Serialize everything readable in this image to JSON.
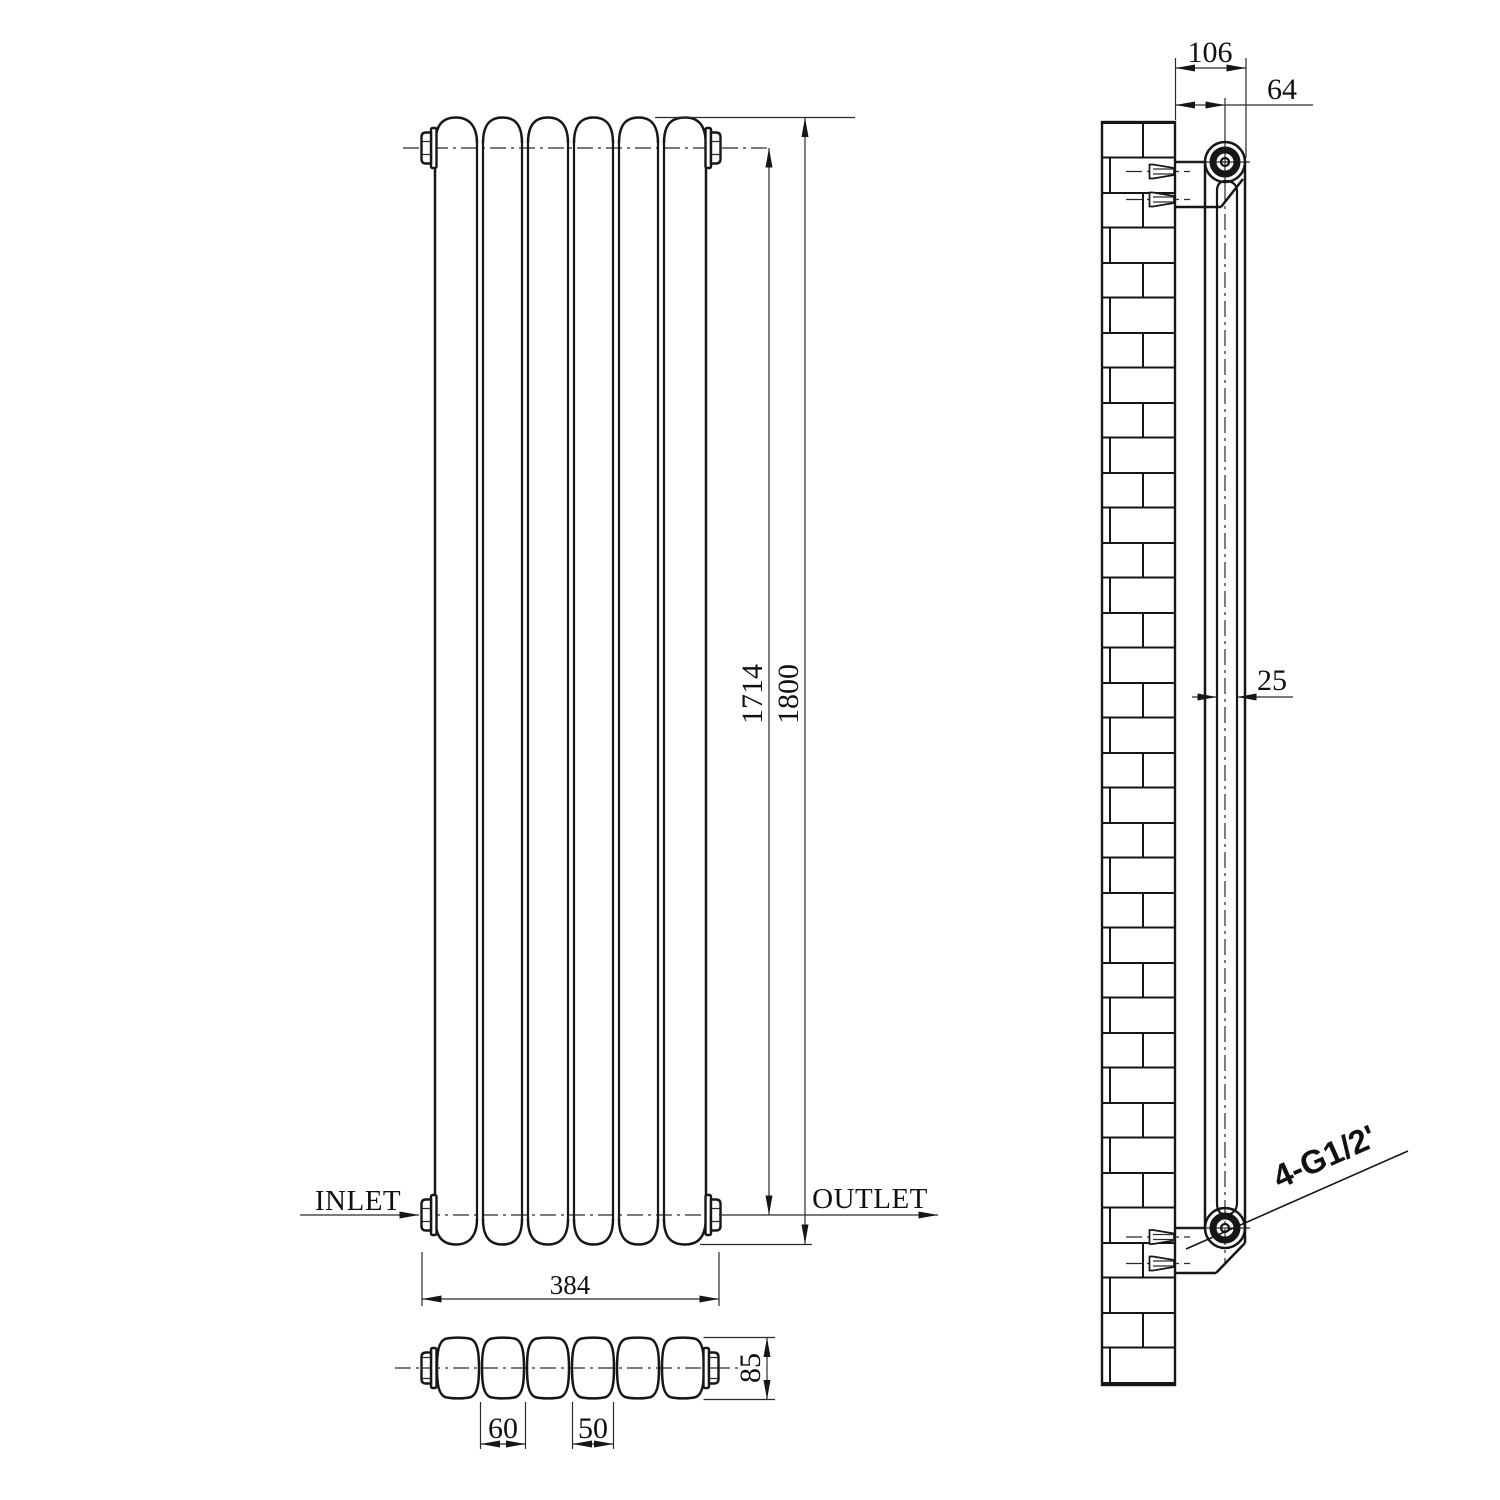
{
  "drawing": {
    "colors": {
      "background": "#ffffff",
      "ink": "#161616"
    },
    "front_view": {
      "inlet_label": "INLET",
      "outlet_label": "OUTLET",
      "dim_center_to_center": "1714",
      "dim_overall_height": "1800",
      "dim_overall_width": "384"
    },
    "plan_view": {
      "dim_column_pitch": "60",
      "dim_column_width": "50",
      "dim_depth": "85"
    },
    "side_view": {
      "dim_wall_bracket_depth": "106",
      "dim_wall_to_axis": "64",
      "dim_panel_thickness": "25",
      "connection_label": "4-G1/2'"
    }
  }
}
